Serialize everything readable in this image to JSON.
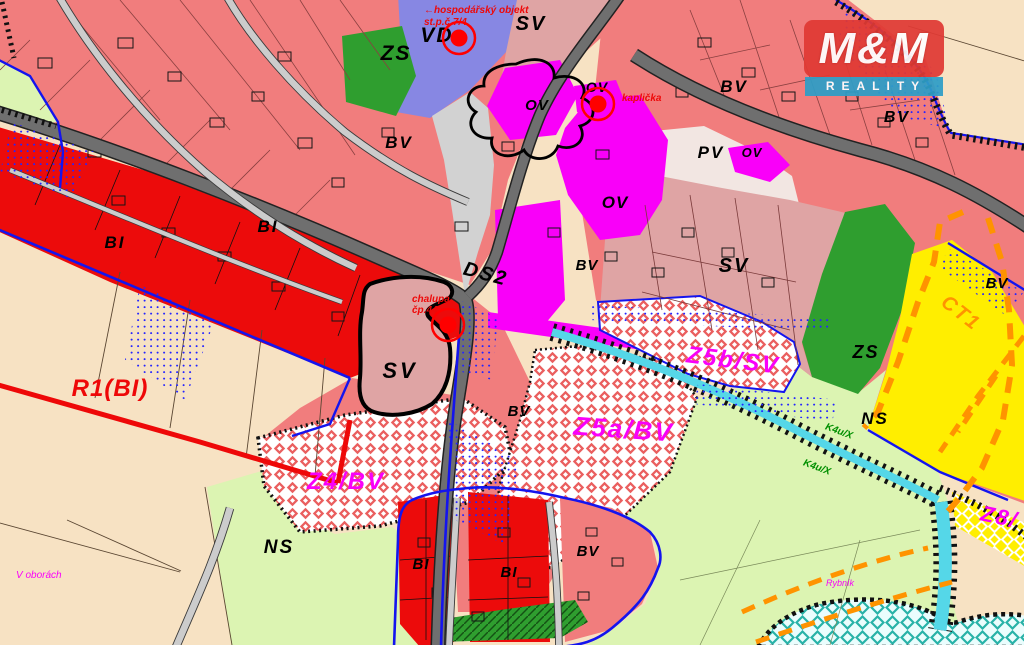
{
  "palette": {
    "beige": "#f7e2c3",
    "salmon": "#f17d7d",
    "red": "#ec0b0b",
    "dusty": "#dfa4a4",
    "magenta": "#f900f9",
    "periwinkle": "#8787e3",
    "green": "#2f9e2f",
    "lightgreen": "#dcf4b2",
    "yellow": "#ffee00",
    "pale": "#f2e6e2",
    "road_major": "#6f6f6f",
    "road_minor": "#cccccc",
    "cyan": "#55d7e8",
    "blue_boundary": "#1414ee",
    "orange_dash": "#ff9300",
    "checker_red": "#ea5f5f",
    "pond_teal": "#28b2a8",
    "logo_red": "#e03a34",
    "logo_blue": "#2e9ec7"
  },
  "logo": {
    "top": "M&M",
    "band": "REALITY"
  },
  "map": {
    "marker_style": {
      "dot_r": 8.5,
      "ring_r": 16,
      "color": "#ff0000"
    },
    "markers": [
      {
        "x": 459,
        "y": 38
      },
      {
        "x": 598,
        "y": 104
      },
      {
        "x": 448,
        "y": 325
      }
    ],
    "labels": [
      {
        "name": "zone-label-zs-top",
        "text": "ZS",
        "x": 396,
        "y": 60,
        "size": 21,
        "color": "#000000",
        "ls": 2
      },
      {
        "name": "zone-label-vd",
        "text": "VD",
        "x": 437,
        "y": 42,
        "size": 21,
        "color": "#000000",
        "ls": 2
      },
      {
        "name": "zone-label-sv-top",
        "text": "SV",
        "x": 531,
        "y": 30,
        "size": 20,
        "color": "#000000",
        "ls": 2
      },
      {
        "name": "zone-label-bv-left",
        "text": "BV",
        "x": 399,
        "y": 148,
        "size": 17,
        "color": "#000000",
        "ls": 2
      },
      {
        "name": "zone-label-bv-topright",
        "text": "BV",
        "x": 734,
        "y": 92,
        "size": 17,
        "color": "#000000",
        "ls": 2
      },
      {
        "name": "zone-label-bv-right",
        "text": "BV",
        "x": 897,
        "y": 122,
        "size": 16,
        "color": "#000000",
        "ls": 2
      },
      {
        "name": "zone-label-pv",
        "text": "PV",
        "x": 711,
        "y": 158,
        "size": 17,
        "color": "#000000",
        "ls": 2
      },
      {
        "name": "zone-label-ov-1",
        "text": "OV",
        "x": 537,
        "y": 110,
        "size": 15,
        "color": "#000000",
        "ls": 1
      },
      {
        "name": "zone-label-ov-2",
        "text": "OV",
        "x": 597,
        "y": 92,
        "size": 14,
        "color": "#000000",
        "ls": 1
      },
      {
        "name": "zone-label-ov-3",
        "text": "OV",
        "x": 615,
        "y": 208,
        "size": 17,
        "color": "#000000",
        "ls": 1
      },
      {
        "name": "zone-label-ov-4",
        "text": "OV",
        "x": 752,
        "y": 157,
        "size": 13,
        "color": "#000000",
        "ls": 1
      },
      {
        "name": "road-label-ds2",
        "text": "DS2",
        "x": 484,
        "y": 280,
        "size": 20,
        "color": "#000000",
        "rotate": 15,
        "ls": 2
      },
      {
        "name": "zone-label-sv-center",
        "text": "SV",
        "x": 400,
        "y": 378,
        "size": 22,
        "color": "#000000",
        "ls": 3
      },
      {
        "name": "zone-label-sv-right",
        "text": "SV",
        "x": 734,
        "y": 272,
        "size": 20,
        "color": "#000000",
        "ls": 2
      },
      {
        "name": "zone-label-bv-mid",
        "text": "BV",
        "x": 587,
        "y": 270,
        "size": 15,
        "color": "#000000",
        "ls": 1
      },
      {
        "name": "zone-label-bv-center",
        "text": "BV",
        "x": 519,
        "y": 416,
        "size": 15,
        "color": "#000000",
        "ls": 1
      },
      {
        "name": "zone-label-bv-bottom",
        "text": "BV",
        "x": 588,
        "y": 556,
        "size": 15,
        "color": "#000000",
        "ls": 1
      },
      {
        "name": "zone-label-bv-edge",
        "text": "BV",
        "x": 997,
        "y": 288,
        "size": 15,
        "color": "#000000",
        "ls": 1
      },
      {
        "name": "zone-label-bi-1",
        "text": "BI",
        "x": 115,
        "y": 248,
        "size": 17,
        "color": "#000000",
        "ls": 2
      },
      {
        "name": "zone-label-bi-2",
        "text": "BI",
        "x": 268,
        "y": 232,
        "size": 17,
        "color": "#000000",
        "ls": 2
      },
      {
        "name": "zone-label-bi-3",
        "text": "BI",
        "x": 421,
        "y": 569,
        "size": 15,
        "color": "#000000",
        "ls": 1
      },
      {
        "name": "zone-label-bi-4",
        "text": "BI",
        "x": 509,
        "y": 577,
        "size": 15,
        "color": "#000000",
        "ls": 1
      },
      {
        "name": "zone-label-ns-left",
        "text": "NS",
        "x": 279,
        "y": 553,
        "size": 19,
        "color": "#000000",
        "ls": 2
      },
      {
        "name": "zone-label-ns-right",
        "text": "NS",
        "x": 875,
        "y": 424,
        "size": 17,
        "color": "#000000",
        "ls": 2
      },
      {
        "name": "zone-label-zs-right",
        "text": "ZS",
        "x": 866,
        "y": 358,
        "size": 18,
        "color": "#000000",
        "ls": 2
      },
      {
        "name": "zone-label-z4bv",
        "text": "Z4/BV",
        "x": 346,
        "y": 489,
        "size": 24,
        "color": "#f900f9",
        "ls": 2
      },
      {
        "name": "zone-label-z5abv",
        "text": "Z5a/BV",
        "x": 623,
        "y": 438,
        "size": 26,
        "color": "#f900f9",
        "rotate": 4,
        "ls": 2
      },
      {
        "name": "zone-label-z5bsv",
        "text": "Z5b/SV",
        "x": 732,
        "y": 368,
        "size": 24,
        "color": "#f900f9",
        "rotate": 7,
        "ls": 2
      },
      {
        "name": "zone-label-z8",
        "text": "Z8/",
        "x": 998,
        "y": 524,
        "size": 22,
        "color": "#f900f9",
        "rotate": 12,
        "ls": 2
      },
      {
        "name": "place-label-v-oborach",
        "text": "V oborách",
        "x": 16,
        "y": 578,
        "size": 10,
        "color": "#f900f9",
        "anchor": "start",
        "bold": false
      },
      {
        "name": "place-label-rybnik",
        "text": "Rybník",
        "x": 826,
        "y": 586,
        "size": 9,
        "color": "#f900f9",
        "anchor": "start",
        "bold": false
      },
      {
        "name": "zone-label-r1bi",
        "text": "R1(BI)",
        "x": 110,
        "y": 396,
        "size": 24,
        "color": "#ee0808",
        "ls": 1
      },
      {
        "name": "annotation-hospodarsky-line1",
        "text": "←hospodářský objekt",
        "x": 424,
        "y": 13,
        "size": 10,
        "color": "#ee0808",
        "anchor": "start"
      },
      {
        "name": "annotation-hospodarsky-line2",
        "text": "st.p.č.7/4",
        "x": 424,
        "y": 25,
        "size": 10,
        "color": "#ee0808",
        "anchor": "start"
      },
      {
        "name": "annotation-kaplicka",
        "text": "kaplička",
        "x": 622,
        "y": 101,
        "size": 10,
        "color": "#ee0808",
        "anchor": "start"
      },
      {
        "name": "annotation-chalupa-line1",
        "text": "chalupa",
        "x": 412,
        "y": 302,
        "size": 10,
        "color": "#ee0808",
        "anchor": "start"
      },
      {
        "name": "annotation-chalupa-line2",
        "text": "čp.44",
        "x": 412,
        "y": 313,
        "size": 10,
        "color": "#ee0808",
        "anchor": "start"
      },
      {
        "name": "zone-label-ct1",
        "text": "CT1",
        "x": 957,
        "y": 318,
        "size": 20,
        "color": "#ff9300",
        "rotate": 38,
        "ls": 2
      },
      {
        "name": "zone-label-k4u-1",
        "text": "K4u/X",
        "x": 838,
        "y": 434,
        "size": 10,
        "color": "#008f00",
        "rotate": 20
      },
      {
        "name": "zone-label-k4u-2",
        "text": "K4u/X",
        "x": 816,
        "y": 470,
        "size": 10,
        "color": "#008f00",
        "rotate": 20
      }
    ]
  }
}
